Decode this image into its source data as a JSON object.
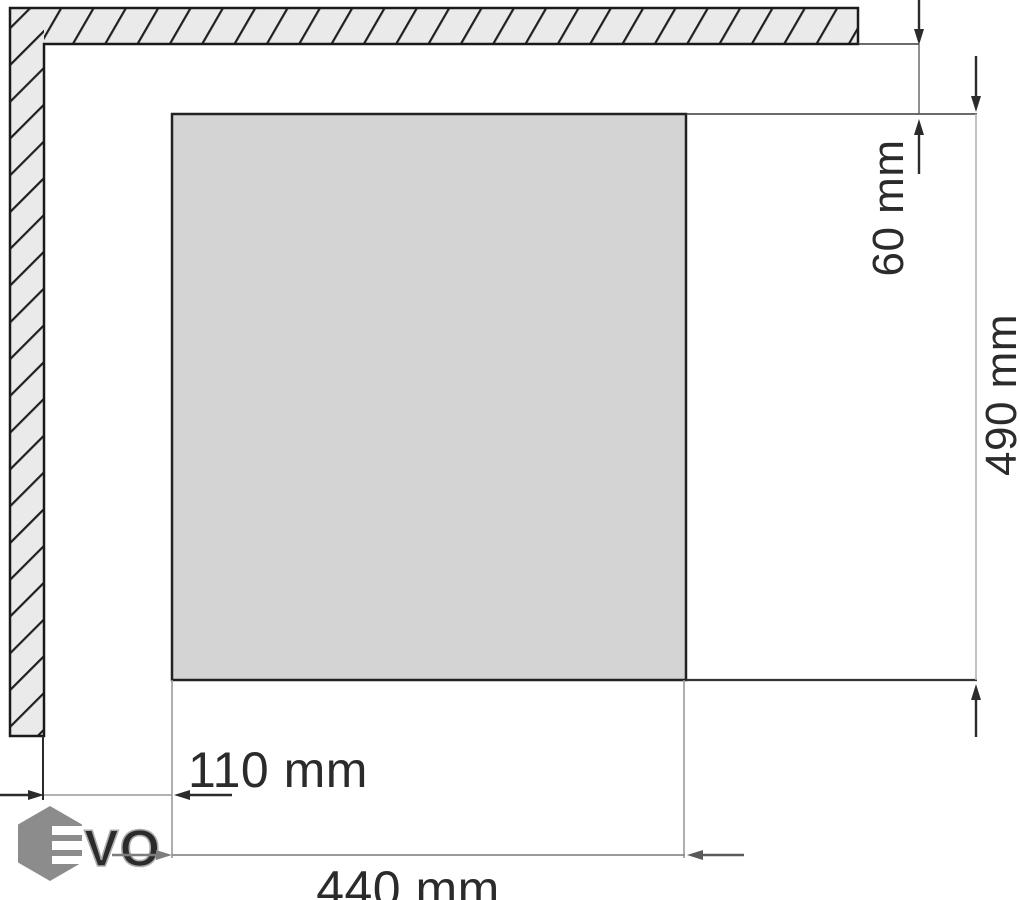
{
  "diagram": {
    "kind": "appliance-cutout-installation-diagram",
    "wall": {
      "description": "hatched wall section, top and left"
    },
    "cutout": {
      "description": "shaded cutout area"
    }
  },
  "dims": {
    "d60": {
      "label": "60 mm",
      "orientation": "vertical",
      "measures": "gap between wall face and top edge of cutout"
    },
    "d490": {
      "label": "490 mm",
      "orientation": "vertical",
      "measures": "cutout height"
    },
    "d110": {
      "label": "110 mm",
      "orientation": "horizontal",
      "measures": "gap between wall face and left edge of cutout"
    },
    "d440": {
      "label": "440 mm",
      "orientation": "horizontal",
      "measures": "cutout width"
    }
  },
  "logo": {
    "brand": "EVO",
    "vo_text": "VO"
  },
  "colors": {
    "wall_fill": "#eaeaea",
    "cutout_fill": "#d4d4d4",
    "ink": "#2b2b2b",
    "light_line": "#9a9a9a",
    "logo_gray": "#8c8c8c"
  }
}
